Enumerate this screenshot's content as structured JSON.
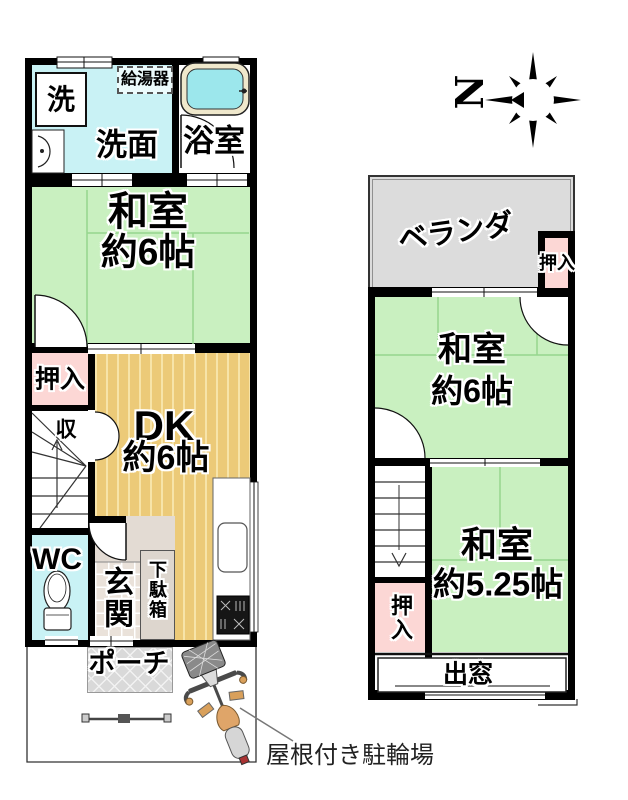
{
  "floor1": {
    "laundry": "洗",
    "water_heater": "給湯器",
    "washroom": "洗面",
    "bathroom": "浴室",
    "tatami_room_line1": "和室",
    "tatami_room_line2": "約6帖",
    "closet": "押入",
    "storage": "収",
    "dk_line1": "DK",
    "dk_line2": "約6帖",
    "toilet": "WC",
    "entrance": "玄関",
    "shoe_cabinet": "下駄箱",
    "porch": "ポーチ"
  },
  "floor2": {
    "veranda": "ベランダ",
    "closet_top": "押入",
    "tatami6_line1": "和室",
    "tatami6_line2": "約6帖",
    "tatami525_line1": "和室",
    "tatami525_line2": "約5.25帖",
    "closet_bottom": "押入",
    "bay_window": "出窓"
  },
  "compass": {
    "north": "N"
  },
  "annotations": {
    "bicycle_parking": "屋根付き駐輪場"
  },
  "colors": {
    "tatami_green": "#c9f0c0",
    "water_cyan": "#c9f2f5",
    "closet_pink": "#fcd7d5",
    "dk_tan": "#ecca78",
    "veranda_gray": "#dcdcdc",
    "entrance_tile": "#eae2da",
    "bath_tub": "#9ce7ec",
    "wall": "#000000"
  }
}
